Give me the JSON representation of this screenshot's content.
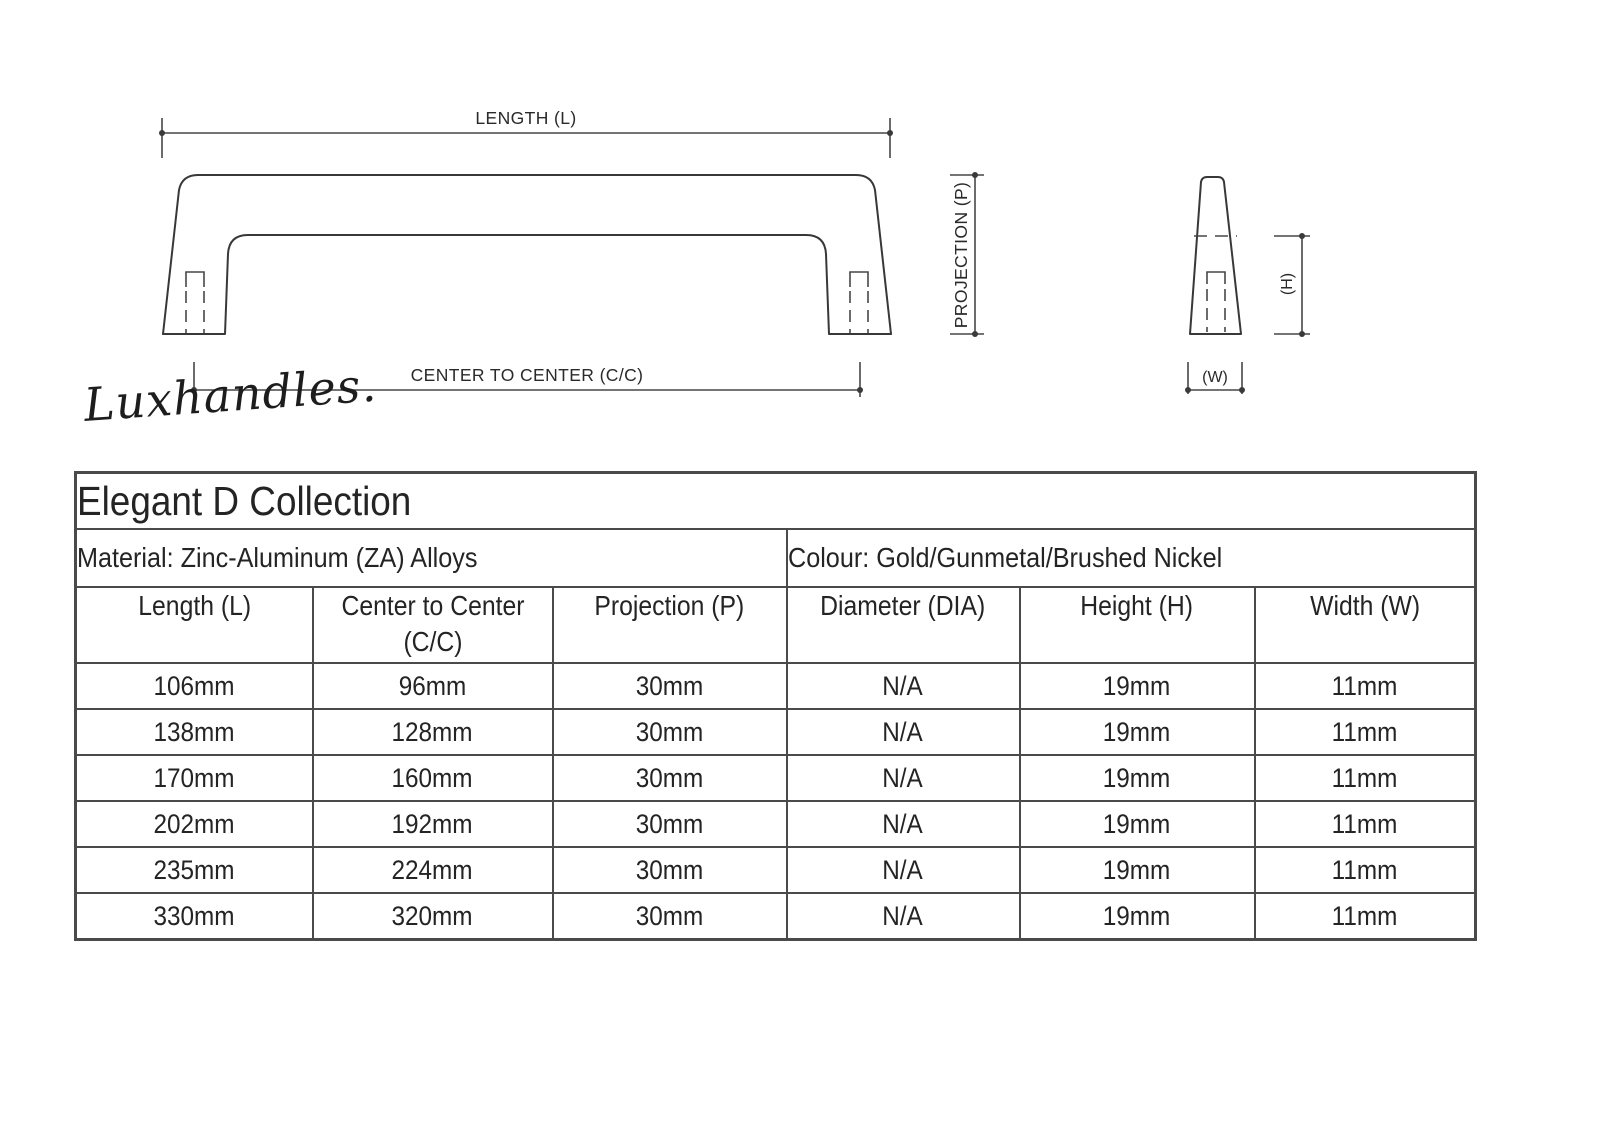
{
  "drawing": {
    "front_view": {
      "length_label": "LENGTH (L)",
      "center_to_center_label": "CENTER TO CENTER (C/C)",
      "projection_label": "PROJECTION (P)"
    },
    "side_view": {
      "height_label": "(H)",
      "width_label": "(W)"
    }
  },
  "brand": {
    "signature": "Luxhandles."
  },
  "table": {
    "title": "Elegant D Collection",
    "material": "Material: Zinc-Aluminum (ZA) Alloys",
    "colour": "Colour: Gold/Gunmetal/Brushed Nickel",
    "columns": [
      "Length (L)",
      "Center to Center (C/C)",
      "Projection (P)",
      "Diameter (DIA)",
      "Height (H)",
      "Width (W)"
    ],
    "rows": [
      [
        "106mm",
        "96mm",
        "30mm",
        "N/A",
        "19mm",
        "11mm"
      ],
      [
        "138mm",
        "128mm",
        "30mm",
        "N/A",
        "19mm",
        "11mm"
      ],
      [
        "170mm",
        "160mm",
        "30mm",
        "N/A",
        "19mm",
        "11mm"
      ],
      [
        "202mm",
        "192mm",
        "30mm",
        "N/A",
        "19mm",
        "11mm"
      ],
      [
        "235mm",
        "224mm",
        "30mm",
        "N/A",
        "19mm",
        "11mm"
      ],
      [
        "330mm",
        "320mm",
        "30mm",
        "N/A",
        "19mm",
        "11mm"
      ]
    ]
  },
  "colors": {
    "background": "#ffffff",
    "line": "#3a3a3a",
    "text": "#242424",
    "table_border": "#4a4a4a"
  }
}
